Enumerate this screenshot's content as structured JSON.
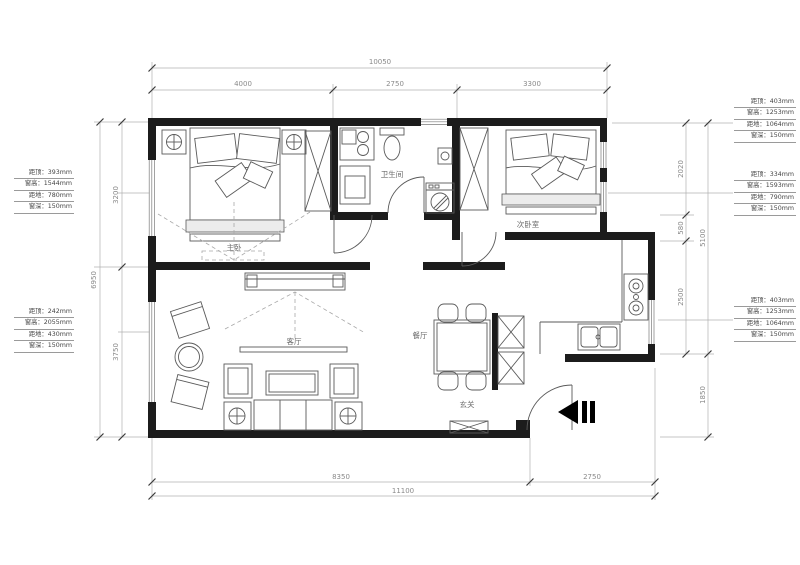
{
  "rooms": {
    "master_bedroom": "主卧",
    "bathroom": "卫生间",
    "second_bedroom": "次卧室",
    "living_room": "客厅",
    "dining_room": "餐厅",
    "entry": "玄关"
  },
  "dimensions": {
    "top": {
      "overall": "10050",
      "segments": [
        "4000",
        "2750",
        "3300"
      ]
    },
    "bottom": {
      "overall": "11100",
      "segments": [
        "8350",
        "2750"
      ]
    },
    "left": {
      "overall": "6950",
      "segments": [
        "3200",
        "3750"
      ]
    },
    "right": {
      "overall": "5100",
      "segments": [
        "2020",
        "580",
        "2500"
      ],
      "below": "1850"
    }
  },
  "window_specs": {
    "left_top": [
      "距顶：393mm",
      "窗高：1544mm",
      "距地：780mm",
      "窗深：150mm"
    ],
    "left_bottom": [
      "距顶：242mm",
      "窗高：2055mm",
      "距地：430mm",
      "窗深：150mm"
    ],
    "right_top": [
      "距顶：403mm",
      "窗高：1253mm",
      "距地：1064mm",
      "窗深：150mm"
    ],
    "right_middle": [
      "距顶：334mm",
      "窗高：1593mm",
      "距地：790mm",
      "窗深：150mm"
    ],
    "right_lower": [
      "距顶：403mm",
      "窗高：1253mm",
      "距地：1064mm",
      "窗深：150mm"
    ]
  },
  "colors": {
    "wall": "#1c1c1c",
    "furniture_line": "#5a5a5a",
    "dim_line": "#b0b0b0",
    "dim_text": "#8a8a8a"
  }
}
